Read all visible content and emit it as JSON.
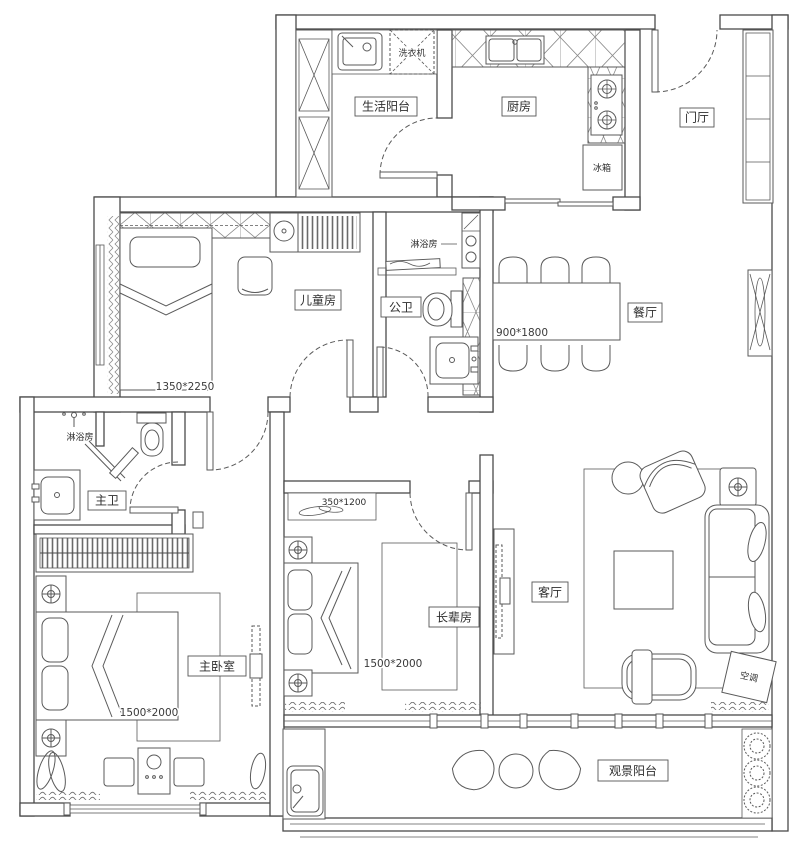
{
  "colors": {
    "wall_line": "#4a4a4a",
    "furniture_line": "#5a5a5a",
    "text": "#2e2e2e",
    "background": "#ffffff"
  },
  "rooms": {
    "life_balcony": {
      "label": "生活阳台"
    },
    "kitchen": {
      "label": "厨房"
    },
    "fridge": {
      "label": "冰箱"
    },
    "washer": {
      "label": "洗衣机"
    },
    "entry_hall": {
      "label": "门厅"
    },
    "children_room": {
      "label": "儿童房",
      "bed_dim": "1350*2250"
    },
    "public_bath": {
      "label": "公卫",
      "shower": "淋浴房"
    },
    "dining": {
      "label": "餐厅",
      "table_dim": "900*1800"
    },
    "master_bath": {
      "label": "主卫",
      "shower": "淋浴房"
    },
    "master_bedroom": {
      "label": "主卧室",
      "bed_dim": "1500*2000"
    },
    "elder_room": {
      "label": "长辈房",
      "bed_dim": "1500*2000",
      "shelf_dim": "350*1200"
    },
    "living_room": {
      "label": "客厅",
      "aircon": "空调"
    },
    "view_balcony": {
      "label": "观景阳台"
    }
  }
}
